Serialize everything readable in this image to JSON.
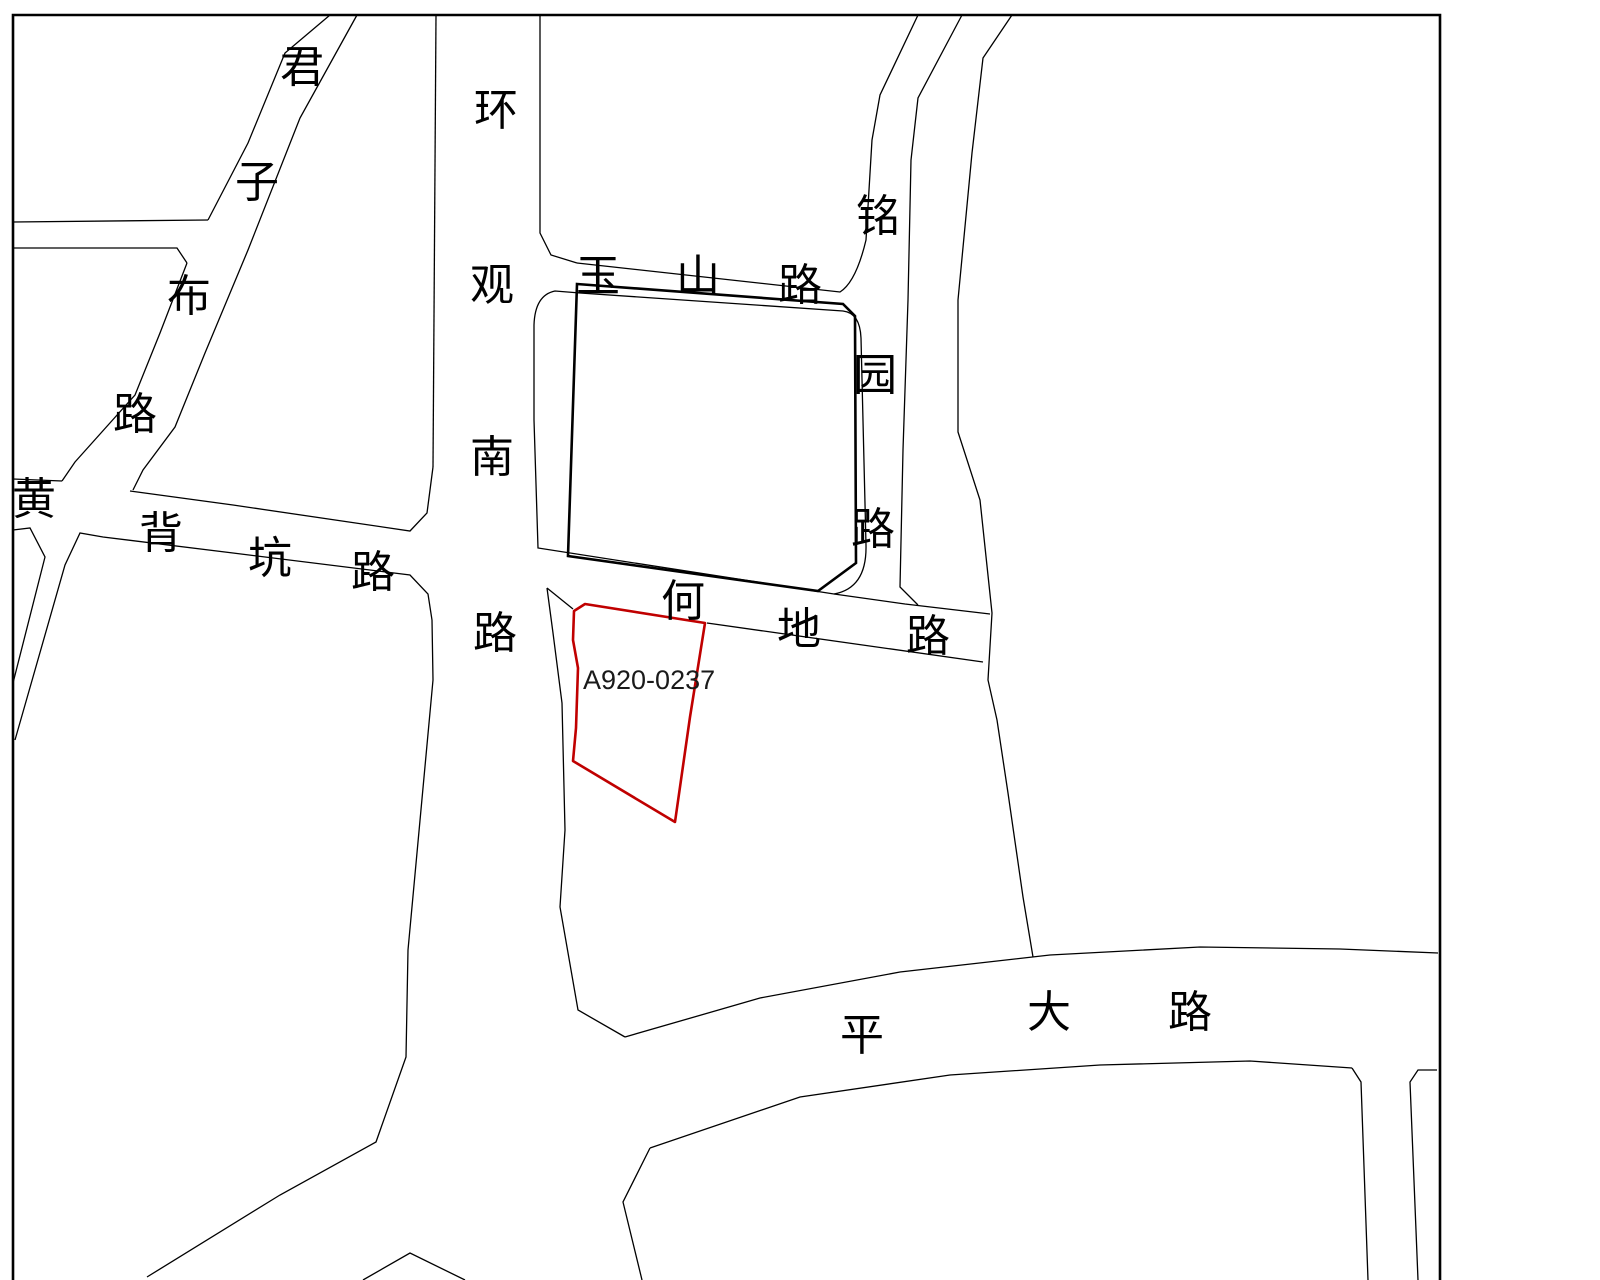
{
  "map": {
    "line_color": "#000000",
    "background_color": "#ffffff",
    "parcel": {
      "id": "A920-0237",
      "outline_color": "#c00000",
      "label_color": "#1a1a1a"
    },
    "roads": [
      {
        "id": "junzibu",
        "name": "君子布路",
        "chars": [
          "君",
          "子",
          "布",
          "路"
        ]
      },
      {
        "id": "huanguannan",
        "name": "环观南路",
        "chars": [
          "环",
          "观",
          "南",
          "路"
        ]
      },
      {
        "id": "yushan",
        "name": "玉山路",
        "chars": [
          "玉",
          "山",
          "路"
        ]
      },
      {
        "id": "mingyuan",
        "name": "铭园路",
        "chars": [
          "铭",
          "园",
          "路"
        ]
      },
      {
        "id": "huangbeikeng",
        "name": "黄背坑路",
        "chars": [
          "黄",
          "背",
          "坑",
          "路"
        ]
      },
      {
        "id": "hedi",
        "name": "何地路",
        "chars": [
          "何",
          "地",
          "路"
        ]
      },
      {
        "id": "pingda",
        "name": "平大路",
        "chars": [
          "平",
          "大",
          "路"
        ]
      }
    ]
  }
}
